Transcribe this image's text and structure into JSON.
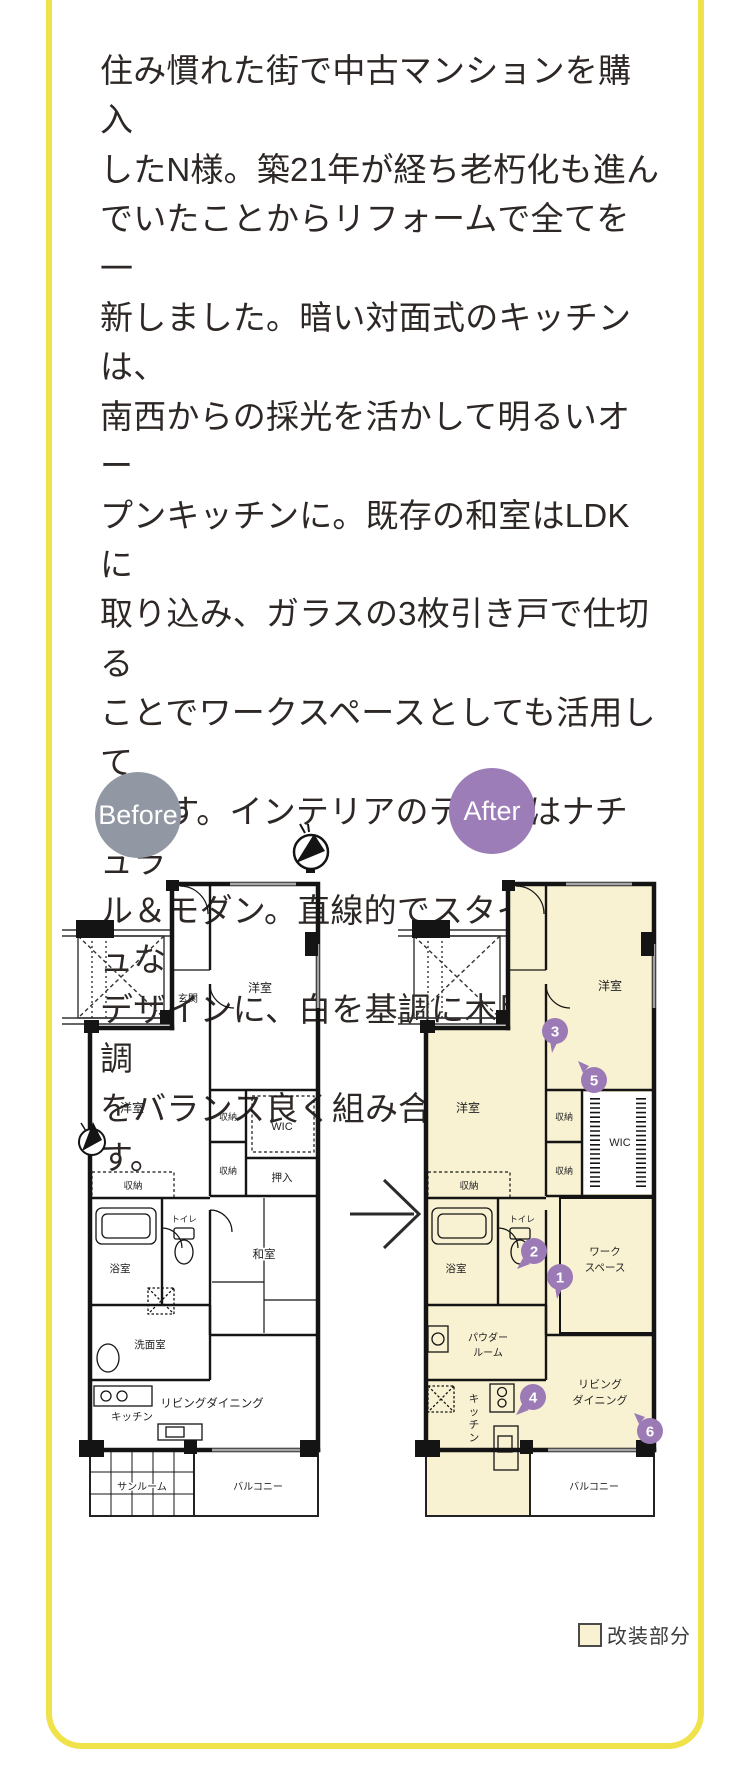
{
  "description": {
    "lines": [
      "住み慣れた街で中古マンションを購入",
      "したN様。築21年が経ち老朽化も進ん",
      "でいたことからリフォームで全てを一",
      "新しました。暗い対面式のキッチンは、",
      "南西からの採光を活かして明るいオー",
      "プンキッチンに。既存の和室はLDKに",
      "取り込み、ガラスの3枚引き戸で仕切る",
      "ことでワークスペースとしても活用して",
      "います。インテリアのテーマはナチュラ",
      "ル＆モダン。直線的でスタイリッシュな",
      "デザインに、白を基調に木目や石目調",
      "をバランス良く組み合わせています。"
    ]
  },
  "before": {
    "badge_label": "Before",
    "rooms": {
      "entrance": "玄関",
      "bedroom_top": "洋室",
      "bedroom_left": "洋室",
      "storage_left": "収納",
      "storage_c1": "収納",
      "storage_c2": "収納",
      "wic": "WIC",
      "oshiire": "押入",
      "washitsu": "和室",
      "bath": "浴室",
      "toilet": "トイレ",
      "washroom": "洗面室",
      "kitchen": "キッチン",
      "living": "リビングダイニング",
      "sunroom": "サンルーム",
      "balcony": "バルコニー"
    }
  },
  "after": {
    "badge_label": "After",
    "rooms": {
      "bedroom_top": "洋室",
      "bedroom_left": "洋室",
      "storage_left": "収納",
      "storage_c1": "収納",
      "storage_c2": "収納",
      "wic": "WIC",
      "workspace_1": "ワーク",
      "workspace_2": "スペース",
      "bath": "浴室",
      "toilet": "トイレ",
      "powder_1": "パウダー",
      "powder_2": "ルーム",
      "living_1": "リビング",
      "living_2": "ダイニング",
      "balcony": "バルコニー"
    },
    "kitchen_vertical": [
      "キ",
      "ッ",
      "チ",
      "ン"
    ],
    "markers": [
      "1",
      "2",
      "3",
      "4",
      "5",
      "6"
    ]
  },
  "legend": {
    "label": "改装部分"
  },
  "colors": {
    "frame_yellow": "#f0e24a",
    "badge_gray": "#9298a3",
    "badge_purple": "#9c7db8",
    "marker_purple": "#9b7ab5",
    "renovation_fill": "#f8f2d2",
    "wall": "#141414",
    "text": "#2d2725"
  }
}
